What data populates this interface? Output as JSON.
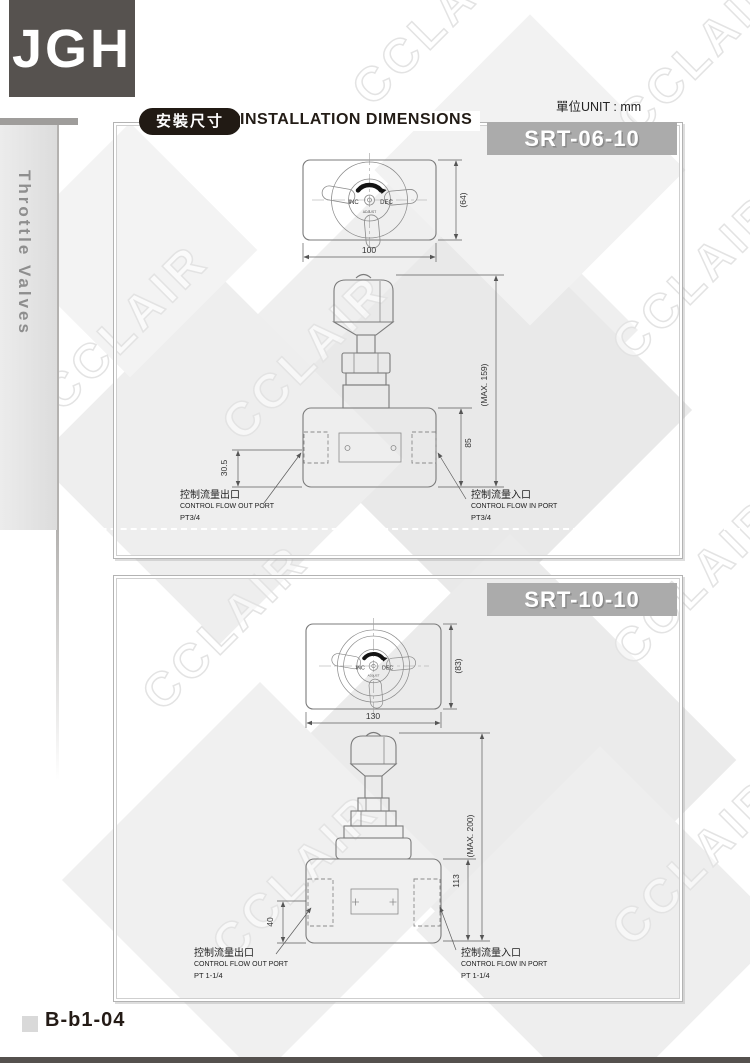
{
  "page": {
    "logo_text": "JGH",
    "sidebar_label": "Throttle Valves",
    "unit_label": "單位UNIT : mm",
    "header_badge": "安裝尺寸",
    "header_title": "INSTALLATION DIMENSIONS",
    "footer_code": "B-b1-04",
    "watermark_text": "CCLAIR"
  },
  "drawings": [
    {
      "model": "SRT-06-10",
      "top_view": {
        "width_dim": "100",
        "height_dim": "(64)",
        "knob_inc": "INC",
        "knob_dec": "DEC",
        "knob_sub": "ADJUST"
      },
      "front_view": {
        "max_height_dim": "(MAX. 159)",
        "port_height_dim": "85",
        "out_port_offset_dim": "30.5"
      },
      "out_port": {
        "zh": "控制流量出口",
        "en": "CONTROL FLOW OUT PORT",
        "thread": "PT3/4"
      },
      "in_port": {
        "zh": "控制流量入口",
        "en": "CONTROL FLOW IN PORT",
        "thread": "PT3/4"
      }
    },
    {
      "model": "SRT-10-10",
      "top_view": {
        "width_dim": "130",
        "height_dim": "(83)",
        "knob_inc": "INC",
        "knob_dec": "DEC",
        "knob_sub": "ADJUST"
      },
      "front_view": {
        "max_height_dim": "(MAX. 200)",
        "port_height_dim": "113",
        "out_port_offset_dim": "40"
      },
      "out_port": {
        "zh": "控制流量出口",
        "en": "CONTROL FLOW OUT PORT",
        "thread": "PT 1-1/4"
      },
      "in_port": {
        "zh": "控制流量入口",
        "en": "CONTROL FLOW IN PORT",
        "thread": "PT 1-1/4"
      }
    }
  ]
}
